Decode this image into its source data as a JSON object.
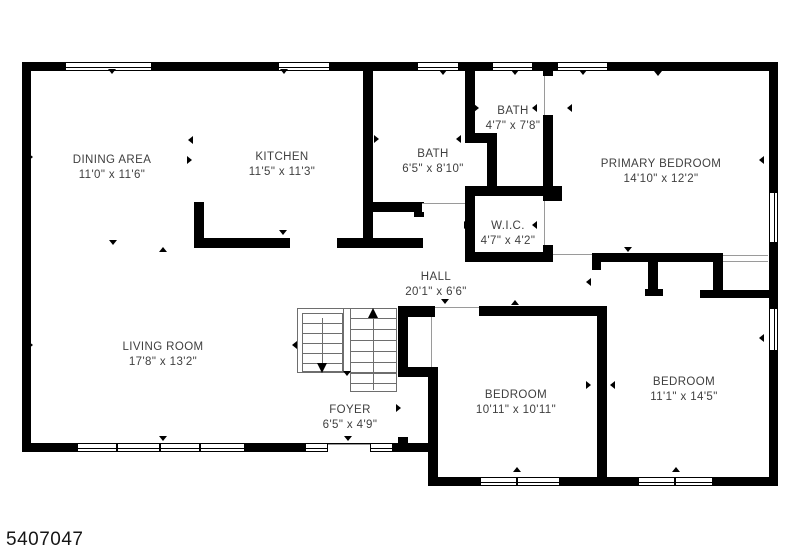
{
  "meta": {
    "width": 800,
    "height": 552,
    "background": "#ffffff",
    "wall_color": "#000000",
    "text_color": "#3f3f3f",
    "watermark": "5407047"
  },
  "plan": {
    "rooms": [
      {
        "name": "DINING AREA",
        "dims": "11'0\" x 11'6\"",
        "cx": 112,
        "cy": 161
      },
      {
        "name": "KITCHEN",
        "dims": "11'5\" x 11'3\"",
        "cx": 282,
        "cy": 158
      },
      {
        "name": "BATH",
        "dims": "6'5\" x 8'10\"",
        "cx": 433,
        "cy": 155
      },
      {
        "name": "BATH",
        "dims": "4'7\" x 7'8\"",
        "cx": 513,
        "cy": 112
      },
      {
        "name": "PRIMARY BEDROOM",
        "dims": "14'10\" x 12'2\"",
        "cx": 661,
        "cy": 165
      },
      {
        "name": "W.I.C.",
        "dims": "4'7\" x 4'2\"",
        "cx": 508,
        "cy": 227
      },
      {
        "name": "HALL",
        "dims": "20'1\" x 6'6\"",
        "cx": 436,
        "cy": 278
      },
      {
        "name": "LIVING ROOM",
        "dims": "17'8\" x 13'2\"",
        "cx": 163,
        "cy": 348
      },
      {
        "name": "FOYER",
        "dims": "6'5\" x 4'9\"",
        "cx": 350,
        "cy": 411
      },
      {
        "name": "BEDROOM",
        "dims": "10'11\" x 10'11\"",
        "cx": 516,
        "cy": 396
      },
      {
        "name": "BEDROOM",
        "dims": "11'1\" x 14'5\"",
        "cx": 684,
        "cy": 383
      }
    ],
    "walls": [
      [
        22,
        62,
        756,
        9
      ],
      [
        22,
        62,
        9,
        390
      ],
      [
        769,
        62,
        9,
        424
      ],
      [
        22,
        443,
        406,
        9
      ],
      [
        428,
        443,
        10,
        43
      ],
      [
        428,
        477,
        350,
        9
      ],
      [
        363,
        62,
        10,
        186
      ],
      [
        363,
        202,
        60,
        10
      ],
      [
        414,
        202,
        10,
        15
      ],
      [
        337,
        238,
        86,
        10
      ],
      [
        194,
        202,
        10,
        46
      ],
      [
        194,
        238,
        96,
        10
      ],
      [
        465,
        62,
        10,
        81
      ],
      [
        465,
        133,
        32,
        10
      ],
      [
        487,
        133,
        10,
        63
      ],
      [
        465,
        186,
        88,
        10
      ],
      [
        465,
        186,
        10,
        76
      ],
      [
        465,
        252,
        88,
        10
      ],
      [
        543,
        62,
        10,
        14
      ],
      [
        543,
        115,
        10,
        71
      ],
      [
        543,
        186,
        19,
        15
      ],
      [
        543,
        245,
        10,
        17
      ],
      [
        592,
        253,
        131,
        9
      ],
      [
        592,
        253,
        9,
        17
      ],
      [
        648,
        262,
        10,
        33
      ],
      [
        645,
        289,
        18,
        7
      ],
      [
        713,
        262,
        10,
        28
      ],
      [
        700,
        290,
        78,
        8
      ],
      [
        398,
        306,
        37,
        11
      ],
      [
        479,
        306,
        118,
        10
      ],
      [
        597,
        306,
        10,
        171
      ],
      [
        428,
        367,
        10,
        110
      ],
      [
        398,
        307,
        10,
        70
      ],
      [
        398,
        367,
        32,
        10
      ],
      [
        398,
        437,
        10,
        15
      ]
    ],
    "openings": [
      {
        "r": [
          328,
          444,
          42,
          8
        ],
        "lines": [
          "top"
        ]
      },
      {
        "r": [
          553,
          254,
          39,
          8
        ],
        "lines": [
          "top"
        ]
      },
      {
        "r": [
          723,
          255,
          45,
          7
        ],
        "lines": [
          "top",
          "bottom"
        ]
      },
      {
        "r": [
          544,
          76,
          8,
          39
        ],
        "lines": [
          "left"
        ]
      },
      {
        "r": [
          544,
          201,
          8,
          44
        ],
        "lines": [
          "left"
        ]
      },
      {
        "r": [
          435,
          307,
          44,
          9
        ],
        "lines": [
          "top"
        ]
      },
      {
        "r": [
          422,
          203,
          43,
          9
        ],
        "lines": [
          "top"
        ]
      },
      {
        "r": [
          431,
          317,
          2,
          50
        ],
        "lines": [
          "left"
        ]
      },
      {
        "r": [
          399,
          377,
          8,
          60
        ],
        "lines": []
      }
    ],
    "windows": [
      {
        "r": [
          65,
          62,
          87,
          9
        ],
        "o": "h"
      },
      {
        "r": [
          278,
          62,
          52,
          9
        ],
        "o": "h"
      },
      {
        "r": [
          417,
          62,
          42,
          9
        ],
        "o": "h"
      },
      {
        "r": [
          492,
          62,
          41,
          9
        ],
        "o": "h"
      },
      {
        "r": [
          557,
          62,
          51,
          9
        ],
        "o": "h"
      },
      {
        "r": [
          769,
          192,
          9,
          51
        ],
        "o": "v"
      },
      {
        "r": [
          769,
          308,
          9,
          43
        ],
        "o": "v"
      },
      {
        "r": [
          77,
          443,
          40,
          9
        ],
        "o": "h"
      },
      {
        "r": [
          117,
          443,
          43,
          9
        ],
        "o": "h"
      },
      {
        "r": [
          160,
          443,
          40,
          9
        ],
        "o": "h"
      },
      {
        "r": [
          200,
          443,
          45,
          9
        ],
        "o": "h"
      },
      {
        "r": [
          305,
          443,
          23,
          9
        ],
        "o": "h"
      },
      {
        "r": [
          370,
          443,
          23,
          9
        ],
        "o": "h"
      },
      {
        "r": [
          480,
          477,
          37,
          9
        ],
        "o": "h"
      },
      {
        "r": [
          517,
          477,
          43,
          9
        ],
        "o": "h"
      },
      {
        "r": [
          638,
          477,
          37,
          9
        ],
        "o": "h"
      },
      {
        "r": [
          675,
          477,
          38,
          9
        ],
        "o": "h"
      }
    ],
    "stairs": {
      "boxes": [
        [
          297,
          308,
          100,
          65
        ],
        [
          302,
          313,
          41,
          59
        ],
        [
          350,
          373,
          47,
          19
        ]
      ],
      "hlines": [
        [
          302,
          323,
          41
        ],
        [
          302,
          333,
          41
        ],
        [
          302,
          343,
          41
        ],
        [
          302,
          353,
          41
        ],
        [
          302,
          363,
          41
        ],
        [
          350,
          318,
          47
        ],
        [
          350,
          329,
          47
        ],
        [
          350,
          340,
          47
        ],
        [
          350,
          351,
          47
        ],
        [
          350,
          362,
          47
        ],
        [
          350,
          383,
          47
        ]
      ],
      "vlines": [
        [
          343,
          308,
          65
        ],
        [
          350,
          308,
          65
        ],
        [
          322,
          318,
          48
        ],
        [
          373,
          316,
          74
        ]
      ],
      "arrows": [
        {
          "x": 322,
          "y": 363,
          "dir": "down"
        },
        {
          "x": 373,
          "y": 308,
          "dir": "up"
        }
      ]
    },
    "ticks": [
      [
        112,
        73,
        "down"
      ],
      [
        284,
        73,
        "down"
      ],
      [
        443,
        74,
        "down"
      ],
      [
        515,
        74,
        "down"
      ],
      [
        583,
        74,
        "down"
      ],
      [
        658,
        75,
        "down"
      ],
      [
        32,
        157,
        "right"
      ],
      [
        32,
        345,
        "right"
      ],
      [
        763,
        160,
        "left"
      ],
      [
        763,
        338,
        "left"
      ],
      [
        192,
        140,
        "left"
      ],
      [
        191,
        160,
        "right"
      ],
      [
        113,
        244,
        "down"
      ],
      [
        163,
        251,
        "up"
      ],
      [
        378,
        139,
        "right"
      ],
      [
        460,
        139,
        "left"
      ],
      [
        283,
        234,
        "down"
      ],
      [
        445,
        303,
        "down"
      ],
      [
        515,
        304,
        "up"
      ],
      [
        590,
        282,
        "left"
      ],
      [
        628,
        251,
        "down"
      ],
      [
        571,
        108,
        "left"
      ],
      [
        536,
        225,
        "left"
      ],
      [
        468,
        225,
        "right"
      ],
      [
        536,
        108,
        "left"
      ],
      [
        478,
        108,
        "right"
      ],
      [
        590,
        385,
        "right"
      ],
      [
        614,
        385,
        "left"
      ],
      [
        517,
        471,
        "up"
      ],
      [
        676,
        471,
        "up"
      ],
      [
        296,
        345,
        "left"
      ],
      [
        400,
        408,
        "right"
      ],
      [
        348,
        440,
        "down"
      ],
      [
        163,
        440,
        "down"
      ],
      [
        347,
        375,
        "down"
      ]
    ]
  }
}
